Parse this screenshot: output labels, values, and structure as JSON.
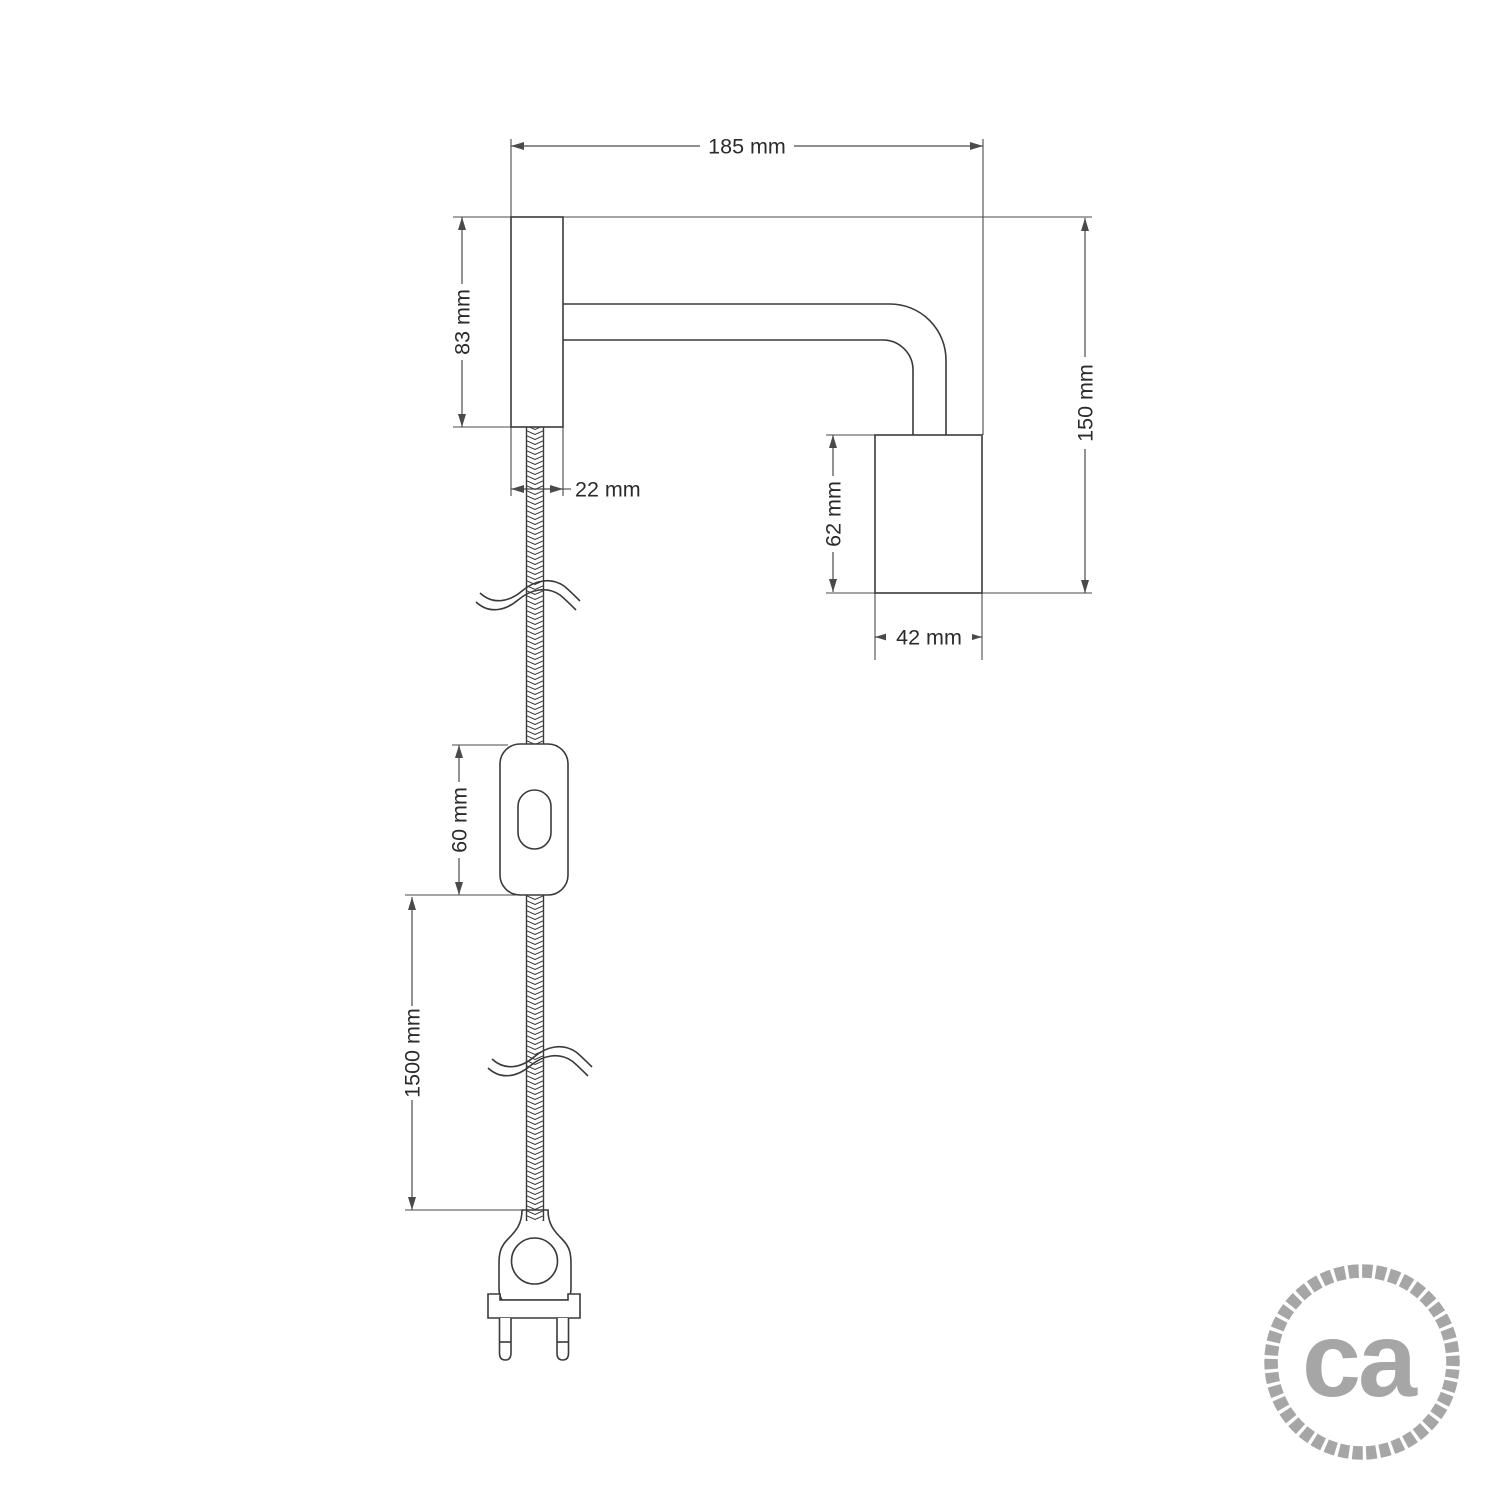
{
  "drawing": {
    "dimensions": {
      "total_width": {
        "label": "185 mm"
      },
      "plate_height": {
        "label": "83 mm"
      },
      "plate_width": {
        "label": "22 mm"
      },
      "total_height": {
        "label": "150 mm"
      },
      "socket_height": {
        "label": "62 mm"
      },
      "socket_width": {
        "label": "42 mm"
      },
      "switch_length": {
        "label": "60 mm"
      },
      "cable_length": {
        "label": "1500 mm"
      }
    },
    "colors": {
      "outline": "#3a3a3a",
      "dimension": "#4a4a4a"
    }
  },
  "logo": {
    "text": "ca",
    "color": "#a6a6a6"
  }
}
